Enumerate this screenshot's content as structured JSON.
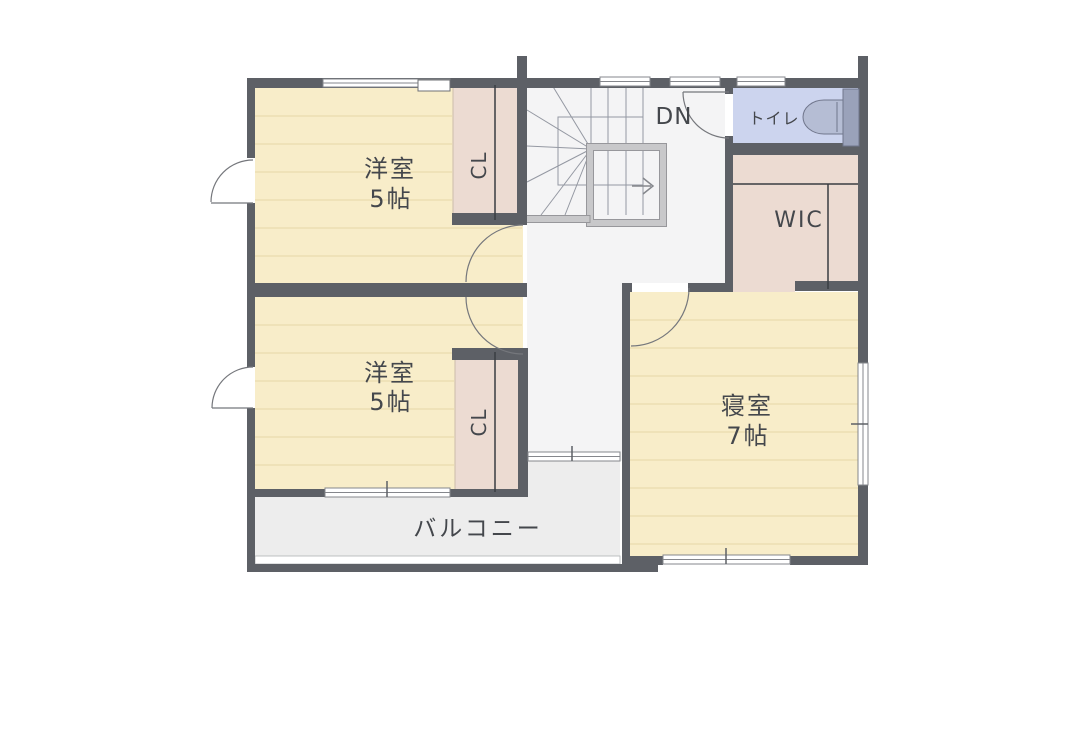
{
  "floor_plan": {
    "type": "second-floor-plan",
    "rooms": [
      {
        "id": "western-room-upper",
        "label": "洋室",
        "size": "5帖"
      },
      {
        "id": "western-room-lower",
        "label": "洋室",
        "size": "5帖"
      },
      {
        "id": "bedroom",
        "label": "寝室",
        "size": "7帖"
      },
      {
        "id": "closet-upper",
        "label": "CL"
      },
      {
        "id": "closet-lower",
        "label": "CL"
      },
      {
        "id": "walk-in-closet",
        "label": "WIC"
      },
      {
        "id": "toilet",
        "label": "トイレ"
      },
      {
        "id": "stairs-down",
        "label": "DN"
      },
      {
        "id": "balcony",
        "label": "バルコニー"
      }
    ],
    "colors": {
      "wall": "#5d6066",
      "room_floor": "#f8edc9",
      "room_floor_line": "#e9dcae",
      "closet_floor": "#ecdbd2",
      "toilet_floor": "#ccd4ee",
      "hallway_floor": "#f4f4f5",
      "balcony_floor": "#ededed",
      "banister": "#c8c8ca",
      "label_text": "#44474c"
    }
  }
}
